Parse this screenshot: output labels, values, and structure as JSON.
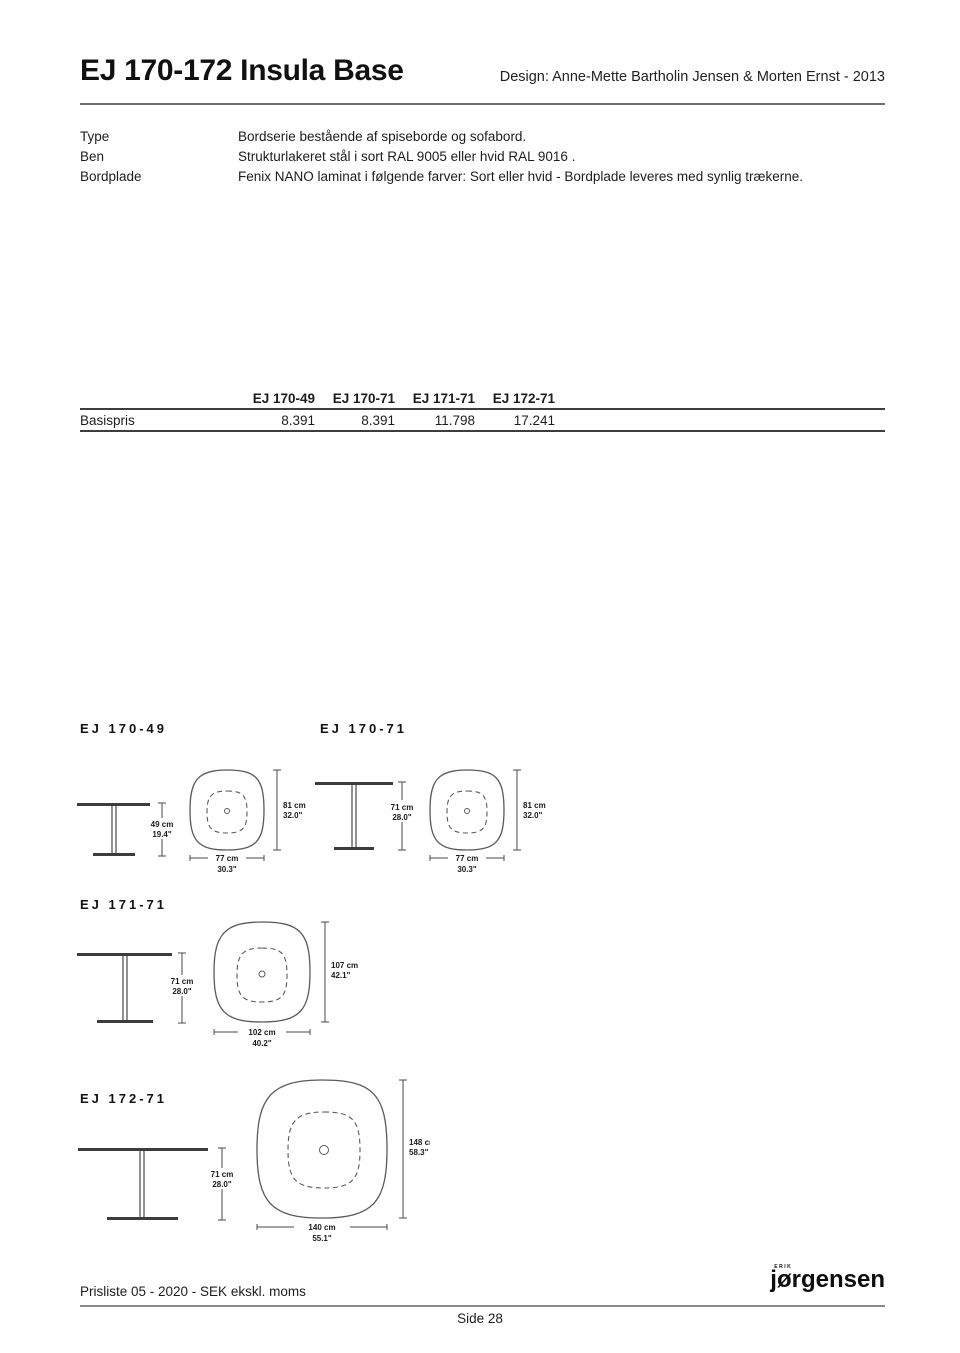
{
  "header": {
    "title": "EJ 170-172 Insula Base",
    "design_credit": "Design: Anne-Mette Bartholin Jensen & Morten Ernst - 2013"
  },
  "specs": [
    {
      "label": "Type",
      "value": "Bordserie bestående af spiseborde og sofabord."
    },
    {
      "label": "Ben",
      "value": "Strukturlakeret stål i sort RAL 9005 eller hvid RAL 9016 ."
    },
    {
      "label": "Bordplade",
      "value": "Fenix NANO laminat i følgende farver: Sort eller hvid - Bordplade leveres med synlig trækerne."
    }
  ],
  "price_table": {
    "columns": [
      "EJ 170-49",
      "EJ 170-71",
      "EJ 171-71",
      "EJ 172-71"
    ],
    "row_label": "Basispris",
    "values": [
      "8.391",
      "8.391",
      "11.798",
      "17.241"
    ]
  },
  "diagrams": [
    {
      "model": "EJ 170-49",
      "side_height_cm": "49 cm",
      "side_height_in": "19.4\"",
      "top_height_cm": "81 cm",
      "top_height_in": "32.0\"",
      "top_width_cm": "77 cm",
      "top_width_in": "30.3\""
    },
    {
      "model": "EJ 170-71",
      "side_height_cm": "71 cm",
      "side_height_in": "28.0\"",
      "top_height_cm": "81 cm",
      "top_height_in": "32.0\"",
      "top_width_cm": "77 cm",
      "top_width_in": "30.3\""
    },
    {
      "model": "EJ 171-71",
      "side_height_cm": "71 cm",
      "side_height_in": "28.0\"",
      "top_height_cm": "107 cm",
      "top_height_in": "42.1\"",
      "top_width_cm": "102 cm",
      "top_width_in": "40.2\""
    },
    {
      "model": "EJ 172-71",
      "side_height_cm": "71 cm",
      "side_height_in": "28.0\"",
      "top_height_cm": "148 cm",
      "top_height_in": "58.3\"",
      "top_width_cm": "140 cm",
      "top_width_in": "55.1\""
    }
  ],
  "footer": {
    "left": "Prisliste 05 - 2020 - SEK ekskl. moms",
    "brand_small": "ERIK",
    "brand": "jørgensen",
    "page_number": "Side 28"
  },
  "colors": {
    "ink": "#1a1a1a",
    "rule": "#6e6e6e",
    "drawing": "#5a5a5a"
  }
}
